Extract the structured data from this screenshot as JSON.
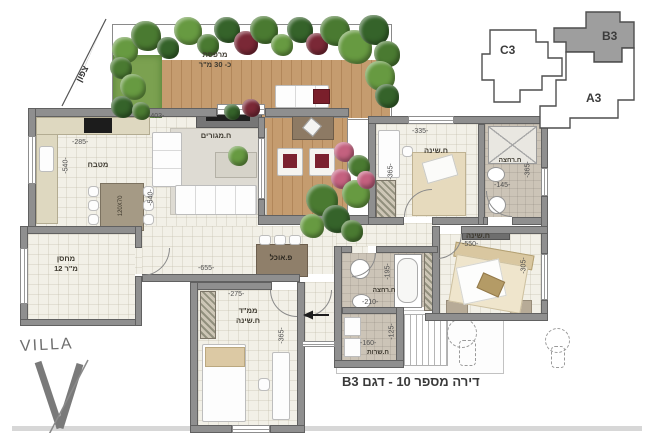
{
  "plan": {
    "caption": "דירה מספר 10 - דגם B3",
    "logo_text": "VILLA",
    "north_label": "צפון",
    "key_plan": {
      "highlighted_unit": "B3",
      "units": [
        {
          "label": "C3"
        },
        {
          "label": "B3"
        },
        {
          "label": "A3"
        }
      ]
    },
    "rooms": {
      "terrace": {
        "name": "מרפסת",
        "area": "כ- 30 מ\"ר"
      },
      "kitchen": {
        "name": "מטבח"
      },
      "living": {
        "name": "ח.מגורים"
      },
      "dining": {
        "name": "פ.אוכל"
      },
      "storage": {
        "name": "מחסן",
        "area": "12 מ\"ר"
      },
      "mamad": {
        "name": "ממ\"ד",
        "sub": "ח.שינה"
      },
      "bedroom2": {
        "name": "ח.שינה"
      },
      "bath_top": {
        "name": "ח.רחצה"
      },
      "bath_mid": {
        "name": "ח.רחצה"
      },
      "service": {
        "name": "ח.שרות"
      },
      "master": {
        "name": "ח.שינה"
      },
      "kitchen_table_size": "120X70"
    },
    "dims": {
      "living_w": "-403-",
      "kitchen_w": "-285-",
      "kitchen_h": "-540-",
      "living_h": "-540-",
      "hall_w": "-655-",
      "mamad_w": "-275-",
      "mamad_h": "-365-",
      "bedroom2_w": "-335-",
      "bedroom2_h": "-365-",
      "bath_top_w": "-145-",
      "bath_top_h": "-365-",
      "bath_mid_w": "-210-",
      "bath_mid_h": "-195-",
      "service_w": "-160-",
      "service_h": "-125-",
      "master_w": "-550-",
      "master_h": "-305-"
    }
  }
}
